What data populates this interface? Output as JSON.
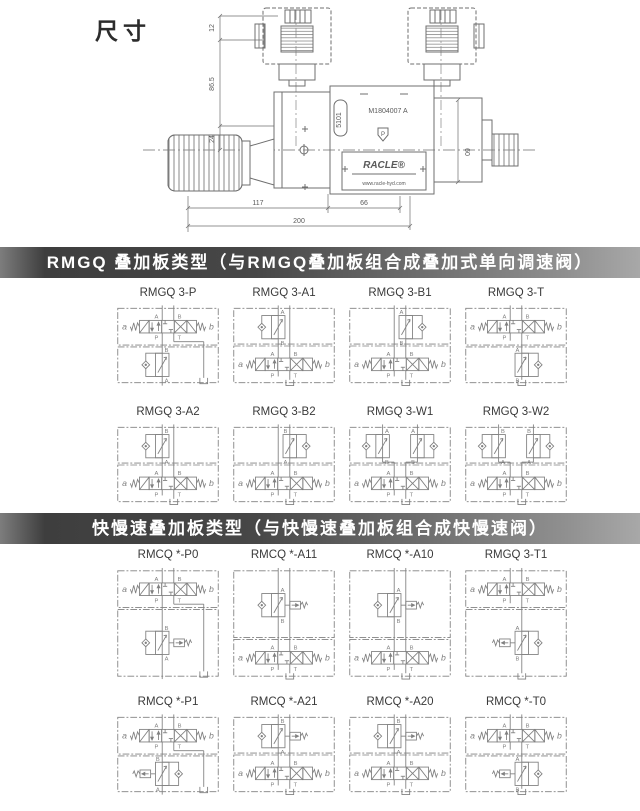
{
  "header": {
    "title": "尺寸"
  },
  "drawing": {
    "dims": {
      "d12": "12",
      "d865": "86.5",
      "d24": "24",
      "d117": "117",
      "d200": "200",
      "d66": "66",
      "d60": "60"
    },
    "labels": {
      "model": "M1804007 A",
      "code": "5101",
      "mark": "P",
      "brand": "RACLE®",
      "site": "www.racle-hyd.com"
    }
  },
  "symbol_labels": {
    "a": "a",
    "b": "b",
    "A": "A",
    "B": "B",
    "P": "P",
    "T": "T"
  },
  "colors": {
    "line": "#808080",
    "draw_line": "#6f6f6f",
    "text": "#3a3a3a",
    "banner_dark": "#434343",
    "banner_light": "#9c9c9c"
  },
  "sections": [
    {
      "title": "RMGQ 叠加板类型（与RMGQ叠加板组合成叠加式单向调速阀）",
      "cells": [
        {
          "label": "RMGQ 3-P",
          "valve": "top",
          "tank": "right",
          "modules": [
            {
              "on": "P",
              "top": "B",
              "bottom": "A",
              "check": "left",
              "pilot": null
            }
          ]
        },
        {
          "label": "RMGQ 3-A1",
          "valve": "bottom",
          "tank": "center",
          "modules": [
            {
              "on": "A",
              "top": "A",
              "bottom": "B",
              "check": "left",
              "pilot": null
            }
          ]
        },
        {
          "label": "RMGQ 3-B1",
          "valve": "bottom",
          "tank": "center",
          "modules": [
            {
              "on": "B",
              "top": "A",
              "bottom": "B",
              "check": "right",
              "pilot": null
            }
          ]
        },
        {
          "label": "RMGQ 3-T",
          "valve": "top",
          "tank": "center",
          "modules": [
            {
              "on": "T",
              "top": "A",
              "bottom": "B",
              "check": "right",
              "pilot": null
            }
          ]
        },
        {
          "label": "RMGQ 3-A2",
          "valve": "bottom",
          "tank": "center",
          "modules": [
            {
              "on": "A",
              "top": "B",
              "bottom": "A",
              "check": "left",
              "pilot": null
            }
          ]
        },
        {
          "label": "RMGQ 3-B2",
          "valve": "bottom",
          "tank": "center",
          "modules": [
            {
              "on": "B",
              "top": "B",
              "bottom": "A",
              "check": "right",
              "pilot": null
            }
          ]
        },
        {
          "label": "RMGQ 3-W1",
          "valve": "bottom",
          "tank": "center",
          "modules": [
            {
              "on": "A",
              "top": "A",
              "bottom": "B",
              "check": "left",
              "pilot": null
            },
            {
              "on": "B",
              "top": "A",
              "bottom": "B",
              "check": "right",
              "pilot": null
            }
          ]
        },
        {
          "label": "RMGQ 3-W2",
          "valve": "bottom",
          "tank": "center",
          "modules": [
            {
              "on": "A",
              "top": "B",
              "bottom": "A",
              "check": "left",
              "pilot": null
            },
            {
              "on": "B",
              "top": "B",
              "bottom": "A",
              "check": "right",
              "pilot": null
            }
          ]
        }
      ]
    },
    {
      "title": "快慢速叠加板类型（与快慢速叠加板组合成快慢速阀）",
      "cells": [
        {
          "label": "RMCQ *-P0",
          "valve": "top",
          "tank": "right",
          "modules": [
            {
              "on": "P",
              "top": "B",
              "bottom": "A",
              "check": "left",
              "pilot": "right"
            }
          ]
        },
        {
          "label": "RMCQ *-A11",
          "valve": "bottom",
          "tank": "center",
          "modules": [
            {
              "on": "A",
              "top": "A",
              "bottom": "B",
              "check": "left",
              "pilot": "right"
            }
          ]
        },
        {
          "label": "RMCQ *-A10",
          "valve": "bottom",
          "tank": "center",
          "modules": [
            {
              "on": "A",
              "top": "A",
              "bottom": "B",
              "check": "left",
              "pilot": "right"
            }
          ]
        },
        {
          "label": "RMGQ 3-T1",
          "valve": "top",
          "tank": "center",
          "modules": [
            {
              "on": "T",
              "top": "A",
              "bottom": "B",
              "check": "right",
              "pilot": "left"
            }
          ]
        },
        {
          "label": "RMCQ *-P1",
          "valve": "top",
          "tank": "right",
          "modules": [
            {
              "on": "P",
              "top": "B",
              "bottom": "A",
              "check": "right",
              "pilot": "left"
            }
          ]
        },
        {
          "label": "RMCQ *-A21",
          "valve": "bottom",
          "tank": "center",
          "modules": [
            {
              "on": "A",
              "top": "B",
              "bottom": "A",
              "check": "left",
              "pilot": "right"
            }
          ]
        },
        {
          "label": "RMCQ *-A20",
          "valve": "bottom",
          "tank": "center",
          "modules": [
            {
              "on": "A",
              "top": "B",
              "bottom": "A",
              "check": "left",
              "pilot": "right"
            }
          ]
        },
        {
          "label": "RMCQ *-T0",
          "valve": "top",
          "tank": "center",
          "modules": [
            {
              "on": "T",
              "top": "A",
              "bottom": "B",
              "check": "right",
              "pilot": "left"
            }
          ]
        }
      ]
    }
  ]
}
